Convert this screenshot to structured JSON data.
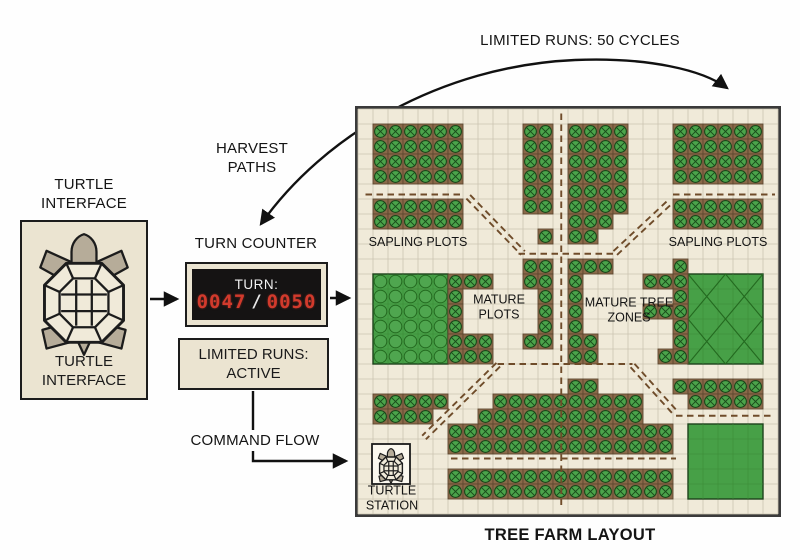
{
  "ui_colors": {
    "digit_red": "#d23a2c",
    "display_bg": "#151313",
    "box_bg": "#ebe4d1",
    "outline": "#1c1c1c",
    "page_bg": "#fefefe"
  },
  "turtle": {
    "top_label_lines": [
      "TURTLE",
      "INTERFACE"
    ],
    "box_label_lines": [
      "TURTLE",
      "INTERFACE"
    ]
  },
  "counter": {
    "heading": "TURN COUNTER",
    "title": "TURN:",
    "current": "0047",
    "separator": "/",
    "total": "0050"
  },
  "status_box": {
    "lines": [
      "LIMITED RUNS:",
      "ACTIVE"
    ]
  },
  "annotations": {
    "limited_runs_arc": "LIMITED RUNS: 50 CYCLES",
    "harvest_paths_lines": [
      "HARVEST",
      "PATHS"
    ],
    "command_flow": "COMMAND FLOW",
    "farm_title": "TREE FARM LAYOUT"
  },
  "farm": {
    "cols": 28,
    "rows": 27,
    "cell": 15,
    "colors": {
      "background": "#f0ead9",
      "grid": "#cbc5b1",
      "border": "#3a3a3a",
      "soil": "#8a6949",
      "soil_border": "#5e4730",
      "leaf": "#4ba44b",
      "leaf_dark": "#1a471a",
      "canopy": "#47a047",
      "canopy_circle": "#4fa64f",
      "canopy_line": "#246a20",
      "path": "#6f4c2a",
      "station_bg": "#fbf8ef",
      "label_ink": "#141414"
    },
    "tree_blocks": [
      [
        1,
        1,
        6,
        4
      ],
      [
        1,
        6,
        6,
        2
      ],
      [
        11,
        1,
        2,
        6
      ],
      [
        12,
        8,
        1,
        1
      ],
      [
        14,
        1,
        4,
        6
      ],
      [
        14,
        7,
        3,
        1
      ],
      [
        14,
        8,
        2,
        1
      ],
      [
        21,
        1,
        6,
        4
      ],
      [
        21,
        6,
        6,
        2
      ],
      [
        6,
        11,
        1,
        6
      ],
      [
        7,
        11,
        2,
        1
      ],
      [
        7,
        15,
        2,
        2
      ],
      [
        11,
        10,
        2,
        2
      ],
      [
        12,
        12,
        1,
        3
      ],
      [
        11,
        15,
        2,
        1
      ],
      [
        14,
        10,
        3,
        1
      ],
      [
        14,
        11,
        1,
        4
      ],
      [
        14,
        15,
        2,
        2
      ],
      [
        21,
        10,
        1,
        7
      ],
      [
        19,
        11,
        2,
        1
      ],
      [
        19,
        13,
        2,
        1
      ],
      [
        20,
        16,
        1,
        1
      ],
      [
        1,
        19,
        5,
        1
      ],
      [
        1,
        20,
        4,
        1
      ],
      [
        9,
        19,
        5,
        1
      ],
      [
        8,
        20,
        6,
        1
      ],
      [
        6,
        21,
        8,
        2
      ],
      [
        6,
        24,
        8,
        2
      ],
      [
        14,
        18,
        2,
        1
      ],
      [
        14,
        19,
        5,
        2
      ],
      [
        14,
        21,
        7,
        2
      ],
      [
        14,
        24,
        7,
        2
      ],
      [
        21,
        18,
        6,
        1
      ],
      [
        22,
        19,
        5,
        1
      ]
    ],
    "green_blocks": [
      {
        "rect": [
          1,
          11,
          5,
          6
        ],
        "style": "circles"
      },
      {
        "rect": [
          22,
          11,
          5,
          6
        ],
        "style": "cross"
      },
      {
        "rect": [
          22,
          21,
          5,
          5
        ],
        "style": "plain"
      }
    ],
    "paths": {
      "horizontal": [
        [
          0.5,
          5.7,
          7.0
        ],
        [
          21.0,
          5.7,
          27.8
        ],
        [
          10.7,
          9.65,
          17.15
        ],
        [
          9.3,
          17.0,
          18.3
        ],
        [
          21.2,
          20.45,
          27.8
        ],
        [
          6.2,
          23.3,
          21.2
        ]
      ],
      "vertical": [
        [
          13.55,
          0.3,
          26.5
        ]
      ],
      "diagonal": [
        [
          7.35,
          5.85,
          11.0,
          9.6
        ],
        [
          17.15,
          9.6,
          20.9,
          6.1
        ],
        [
          9.35,
          17.05,
          4.4,
          21.9
        ],
        [
          18.3,
          17.1,
          21.2,
          20.3
        ]
      ]
    },
    "labels": [
      {
        "name": "label-sapling-plots-left",
        "lines": [
          "SAPLING PLOTS"
        ],
        "x": 60,
        "y": 133,
        "size": 12.5
      },
      {
        "name": "label-sapling-plots-right",
        "lines": [
          "SAPLING PLOTS"
        ],
        "x": 360,
        "y": 133,
        "size": 12.5
      },
      {
        "name": "label-mature-plots",
        "lines": [
          "MATURE",
          "PLOTS"
        ],
        "x": 141,
        "y": 198,
        "size": 12.5
      },
      {
        "name": "label-mature-tree-zones",
        "lines": [
          "MATURE TREE",
          "ZONES"
        ],
        "x": 271,
        "y": 201,
        "size": 12.5
      },
      {
        "name": "label-turtle-station",
        "lines": [
          "TURTLE",
          "STATION"
        ],
        "x": 34,
        "y": 389,
        "size": 12.5
      }
    ],
    "station": {
      "x": 14,
      "y": 335,
      "w": 38,
      "h": 40
    }
  }
}
